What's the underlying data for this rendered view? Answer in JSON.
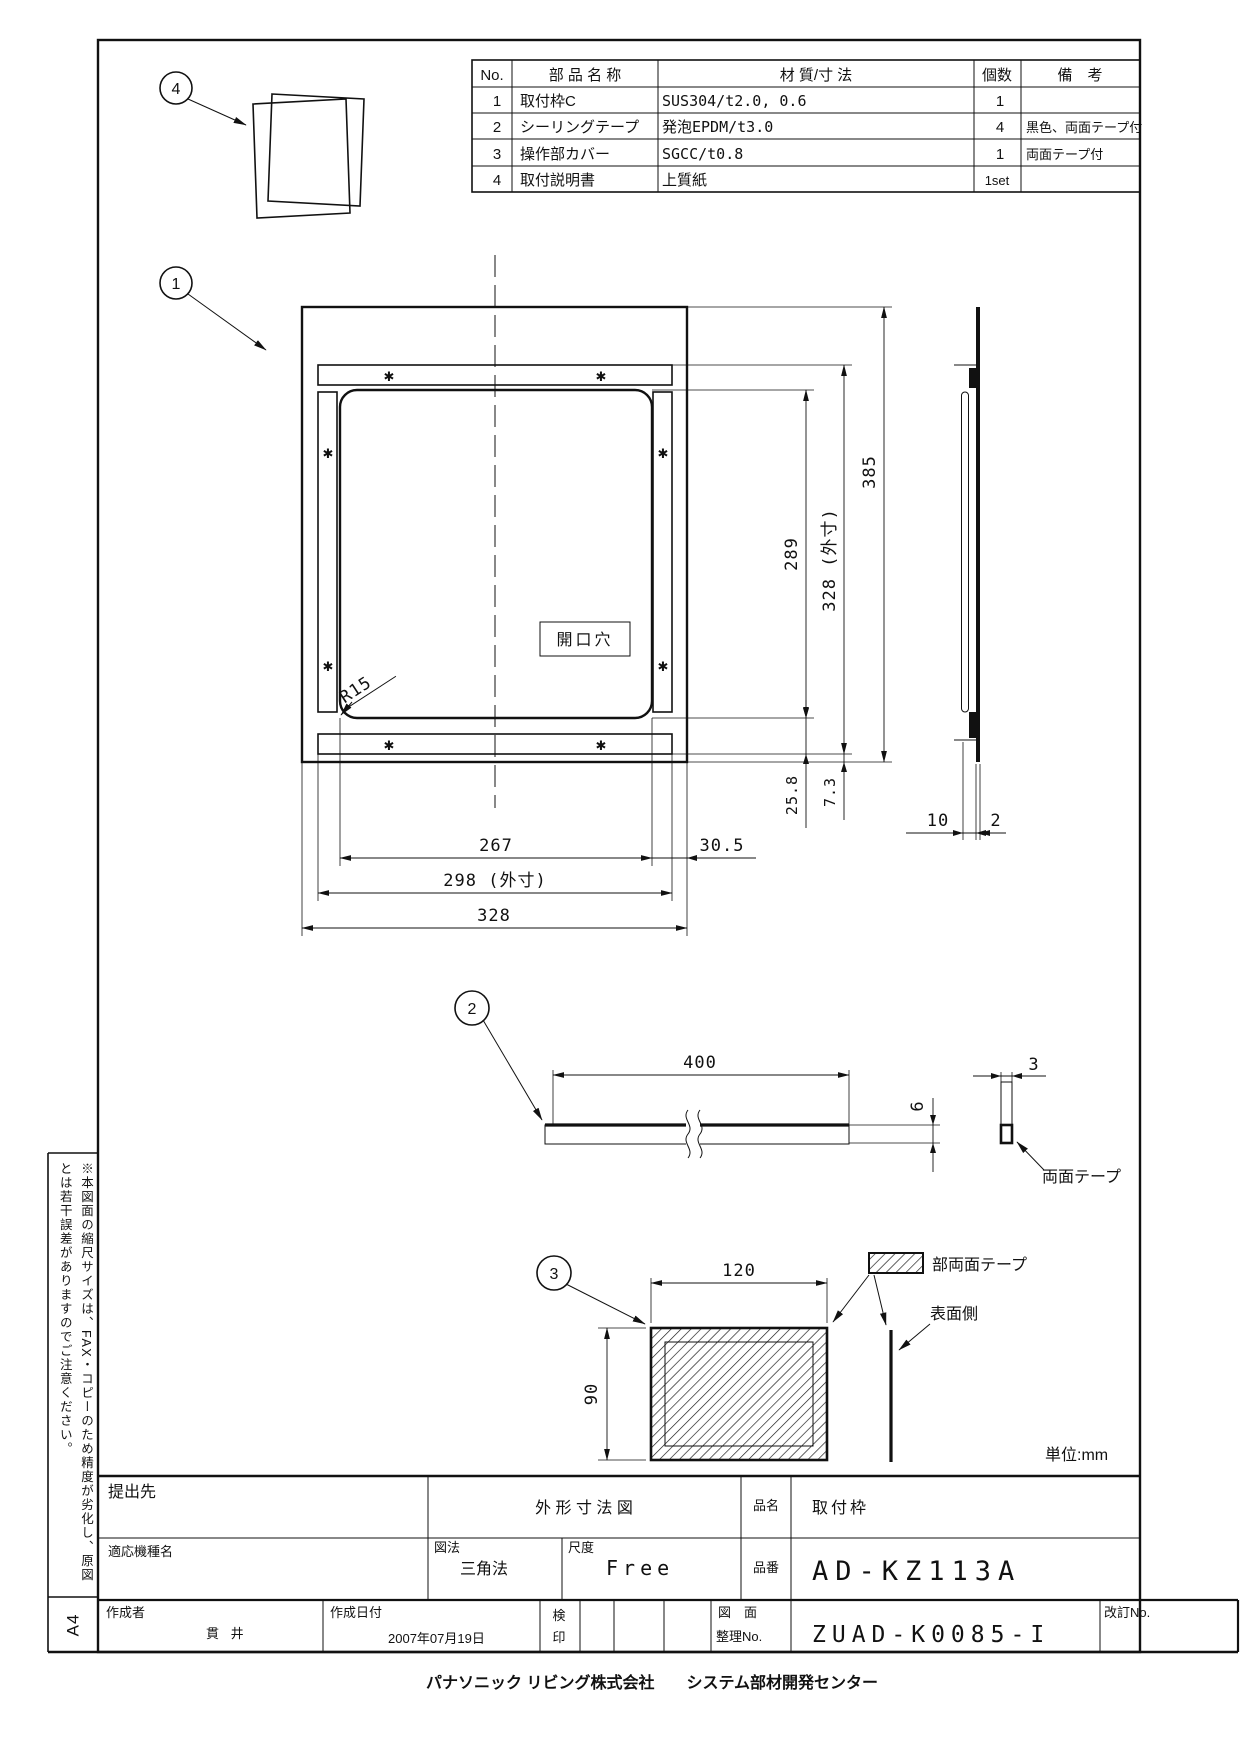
{
  "sheet": {
    "paper_size": "A4",
    "unit_note": "単位:mm",
    "side_note": "※本図面の縮尺サイズは、FAX・コピーのため精度が劣化し、原図とは若干誤差がありますのでご注意ください。",
    "footer": "パナソニック リビング株式会社　　システム部材開発センター"
  },
  "parts_table": {
    "headers": [
      "No.",
      "部 品 名 称",
      "材 質/寸 法",
      "個数",
      "備　考"
    ],
    "rows": [
      [
        "1",
        "取付枠C",
        "SUS304/t2.0, 0.6",
        "1",
        ""
      ],
      [
        "2",
        "シーリングテープ",
        "発泡EPDM/t3.0",
        "4",
        "黒色、両面テープ付"
      ],
      [
        "3",
        "操作部カバー",
        "SGCC/t0.8",
        "1",
        "両面テープ付"
      ],
      [
        "4",
        "取付説明書",
        "上質紙",
        "1set",
        ""
      ]
    ]
  },
  "balloons": {
    "b1": "1",
    "b2": "2",
    "b3": "3",
    "b4": "4"
  },
  "front_view": {
    "opening_label": "開口穴",
    "radius": "R15",
    "tape_mark": "✱",
    "dim_289": "289",
    "dim_328_outer": "328 (外寸)",
    "dim_385": "385",
    "dim_267": "267",
    "dim_298_outer": "298 (外寸)",
    "dim_328": "328",
    "dim_30_5": "30.5",
    "dim_25_8": "25.8",
    "dim_7_3": "7.3"
  },
  "side_view": {
    "dim_10": "10",
    "dim_2": "2"
  },
  "tape_view": {
    "dim_400": "400",
    "dim_6": "6",
    "dim_3": "3",
    "label": "両面テープ"
  },
  "cover_view": {
    "dim_120": "120",
    "dim_90": "90",
    "legend": "部両面テープ",
    "surface": "表面側"
  },
  "title_block": {
    "teishutsusaki_label": "提出先",
    "doc_type": "外 形 寸 法 図",
    "hinmei_label": "品名",
    "hinmei": "取付枠",
    "tekiou_label": "適応機種名",
    "zuhou_label": "図法",
    "zuhou": "三角法",
    "shakudo_label": "尺度",
    "shakudo": "Free",
    "hinban_label": "品番",
    "hinban": "AD-KZ113A",
    "sakusei_label": "作成者",
    "sakusei": "貫 井",
    "date_label": "作成日付",
    "date": "2007年07月19日",
    "keniin_label_1": "検",
    "keniin_label_2": "印",
    "zumen_label_1": "図　面",
    "zumen_label_2": "整理No.",
    "zumen_no": "ZUAD-K0085-I",
    "kaitei_label": "改訂No."
  }
}
